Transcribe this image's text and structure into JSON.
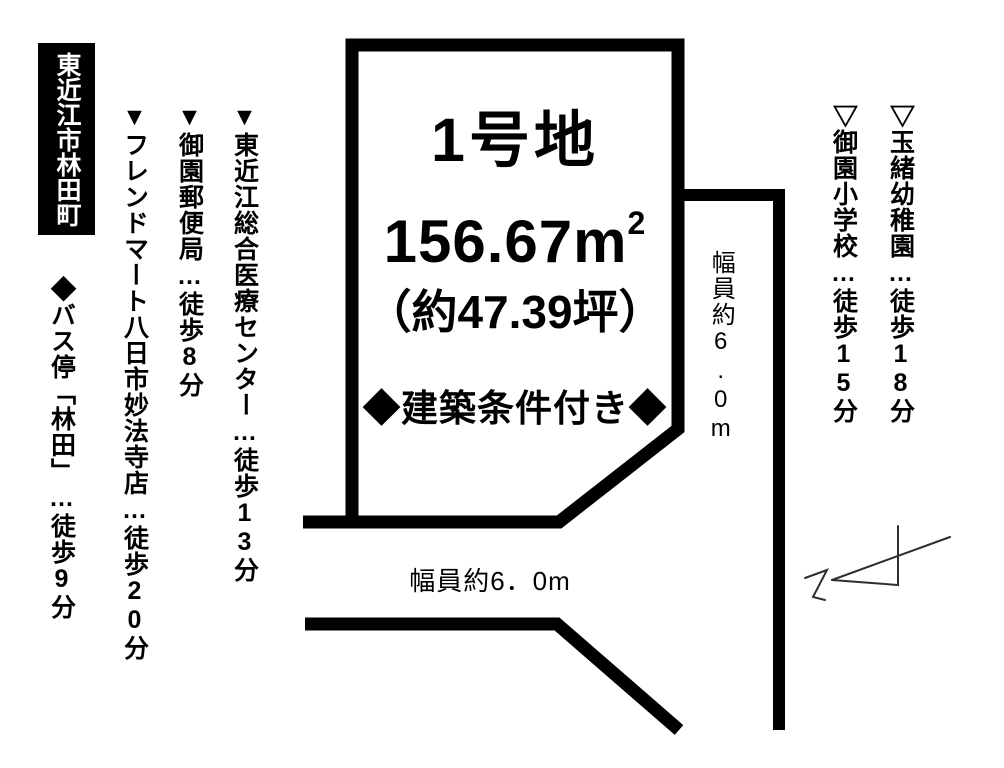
{
  "location_badge": "東近江市林田町",
  "facilities_left": [
    {
      "label": "▼東近江総合医療センター…徒歩13分"
    },
    {
      "label": "▼御園郵便局…徒歩8分"
    },
    {
      "label": "▼フレンドマート八日市妙法寺店…徒歩20分"
    },
    {
      "label": "◆バス停「林田」…徒歩9分"
    }
  ],
  "facilities_right": [
    {
      "label": "▽玉緒幼稚園…徒歩18分"
    },
    {
      "label": "▽御園小学校…徒歩15分"
    }
  ],
  "plot": {
    "name": "1号地",
    "area_sqm": "156.67m",
    "area_sup": "2",
    "area_tsubo": "（約47.39坪）",
    "condition": "◆建築条件付き◆"
  },
  "roads": {
    "right_width_label": "幅員約6.0m",
    "bottom_width_label": "幅員約6．0m"
  },
  "colors": {
    "line": "#000000",
    "badge_bg": "#000000",
    "badge_text": "#ffffff",
    "north_arrow": "#2e2e2e"
  }
}
